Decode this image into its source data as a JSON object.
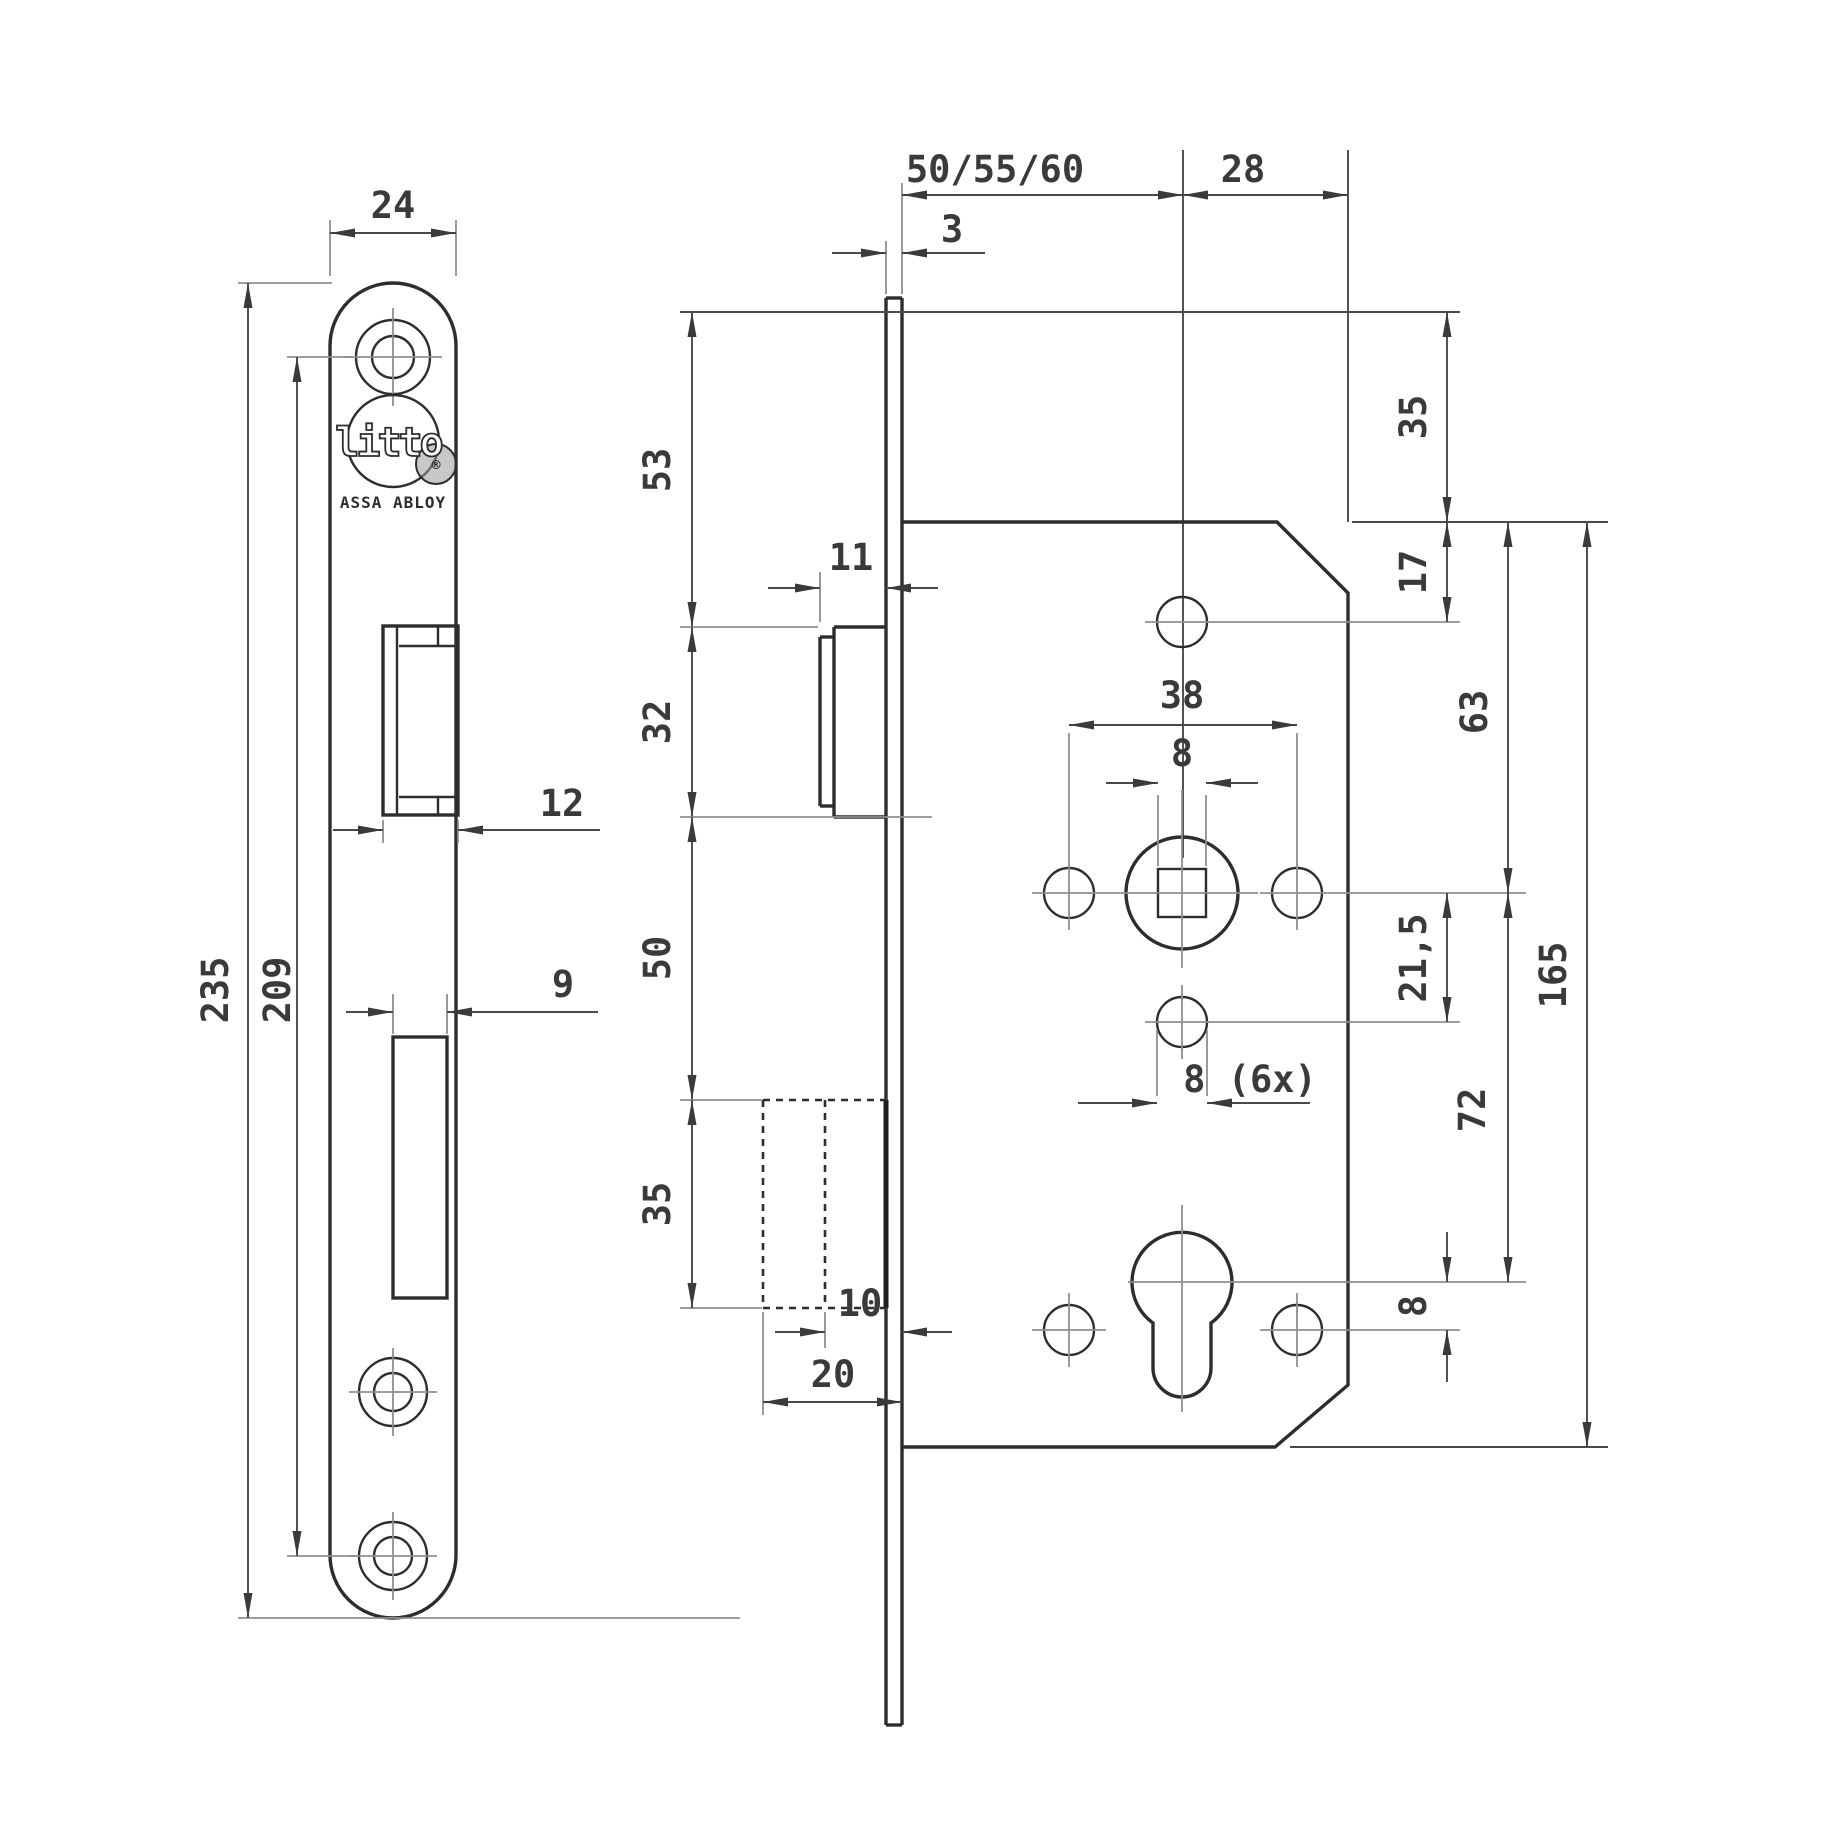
{
  "title": "Litto mortise cylinder lock - dimensional technical drawing",
  "colors": {
    "line": "#2d2d2d",
    "dim": "#4a4a4a",
    "light": "#8f8f8f",
    "background": "#ffffff"
  },
  "logo": {
    "name": "litto",
    "registered": "®",
    "subtext": "ASSA ABLOY"
  },
  "faceplate_view": {
    "width": "24",
    "length": "235",
    "screw_spacing": "209",
    "latch_cutout_width": "12",
    "deadbolt_cutout_width": "9"
  },
  "side_view": {
    "plate_thickness": "3",
    "backset": "50/55/60",
    "edge_to_spindle": "28",
    "top_to_latch": "53",
    "latch_height": "32",
    "latch_to_deadbolt": "50",
    "deadbolt_height": "35",
    "latch_protrusion": "11",
    "deadbolt_inner_offset": "10",
    "deadbolt_pocket_depth": "20"
  },
  "body_view": {
    "top_margin": "35",
    "edge_to_top_hole": "17",
    "handle_hole_spacing": "38",
    "spindle_square": "8",
    "fixing_hole_note": "8 (6x)",
    "spindle_to_lower_hole": "21,5",
    "top_to_spindle": "63",
    "spindle_to_cylinder": "72",
    "case_height": "165",
    "cylinder_to_bottom_hole": "8"
  }
}
